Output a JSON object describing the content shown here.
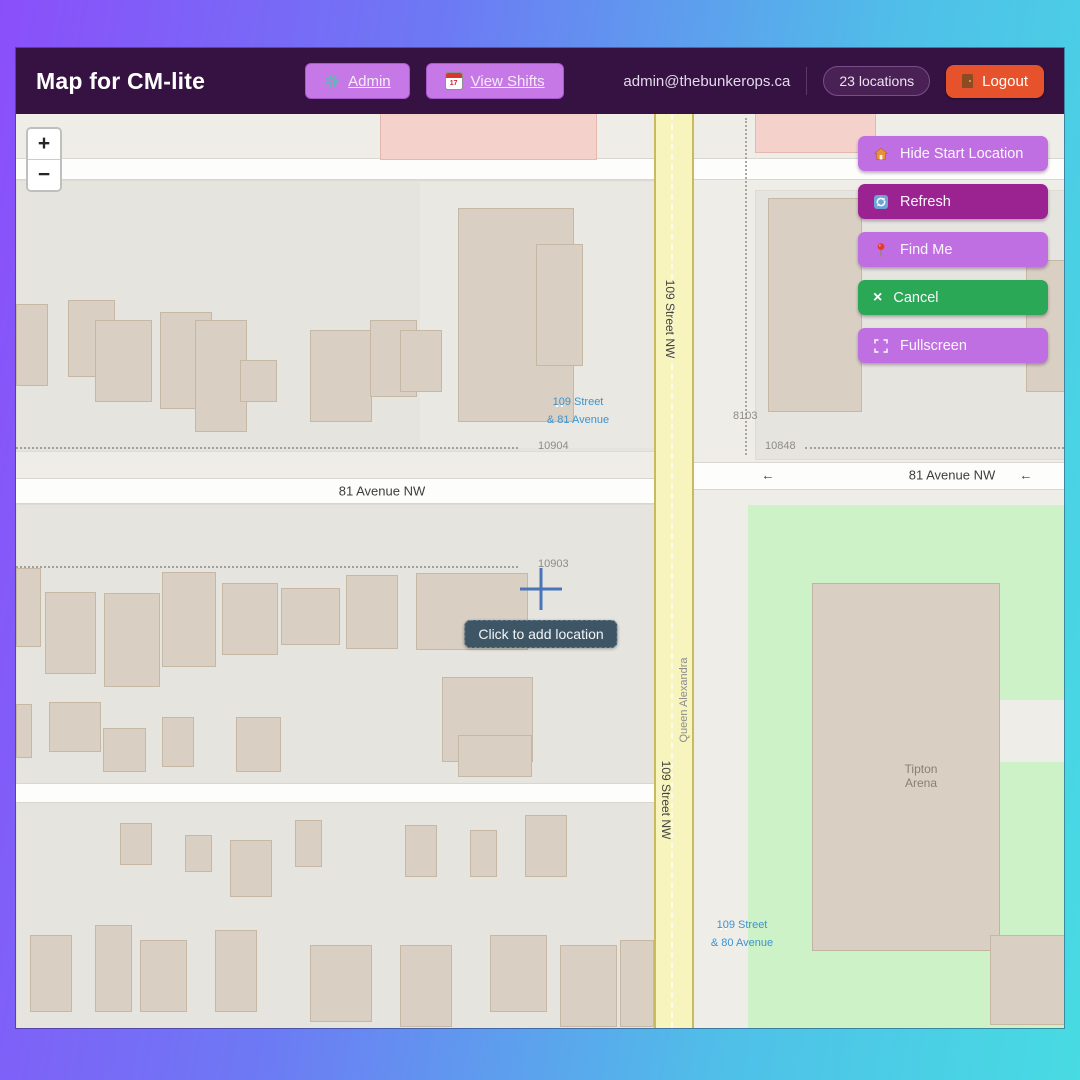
{
  "header": {
    "title": "Map for CM-lite",
    "admin": {
      "label": "Admin",
      "icon": "gear-icon"
    },
    "view_shifts": {
      "label": "View Shifts",
      "icon": "calendar-icon",
      "icon_day": "17"
    },
    "email": "admin@thebunkerops.ca",
    "locations_badge": "23 locations",
    "logout": {
      "label": "Logout",
      "icon": "door-icon"
    }
  },
  "map": {
    "controls": {
      "zoom_in": "+",
      "zoom_out": "−"
    },
    "buttons": [
      {
        "label": "Hide Start Location",
        "icon": "house-icon",
        "color": "#c06fe2"
      },
      {
        "label": "Refresh",
        "icon": "refresh-icon",
        "color": "#9b2391"
      },
      {
        "label": "Find Me",
        "icon": "pin-icon",
        "color": "#c06fe2"
      },
      {
        "label": "Cancel",
        "icon": "x-icon",
        "icon_char": "×",
        "color": "#2aa855"
      },
      {
        "label": "Fullscreen",
        "icon": "fullscreen-icon",
        "color": "#c06fe2"
      }
    ],
    "tooltip": "Click to add location",
    "labels": {
      "street_81_left": "81 Avenue NW",
      "street_81_right": "81 Avenue NW",
      "arrow": "←",
      "street_109_top": "109 Street NW",
      "street_109_bottom": "109 Street NW",
      "queen_alexandra": "Queen Alexandra",
      "tipton_line1": "Tipton",
      "tipton_line2": "Arena",
      "addr_10904": "10904",
      "addr_10848": "10848",
      "addr_8103": "8103",
      "addr_10903": "10903",
      "stop81_line1": "109 Street",
      "stop81_line2": "& 81 Avenue",
      "stop80_line1": "109 Street",
      "stop80_line2": "& 80 Avenue"
    }
  },
  "colors": {
    "frame_gradient_left": "#8b4ffa",
    "frame_gradient_right": "#49d7e8",
    "header_bg": "#351241",
    "accent_purple": "#c06fe2",
    "accent_magenta": "#9b2391",
    "accent_green": "#2aa855",
    "logout_orange": "#e5522b",
    "road_yellow": "#f7f4bd",
    "park_green": "#cdf2c8",
    "building_tan": "#d9d0c3",
    "transit_blue": "#3d93cf",
    "tooltip_bg": "#3e5565"
  }
}
